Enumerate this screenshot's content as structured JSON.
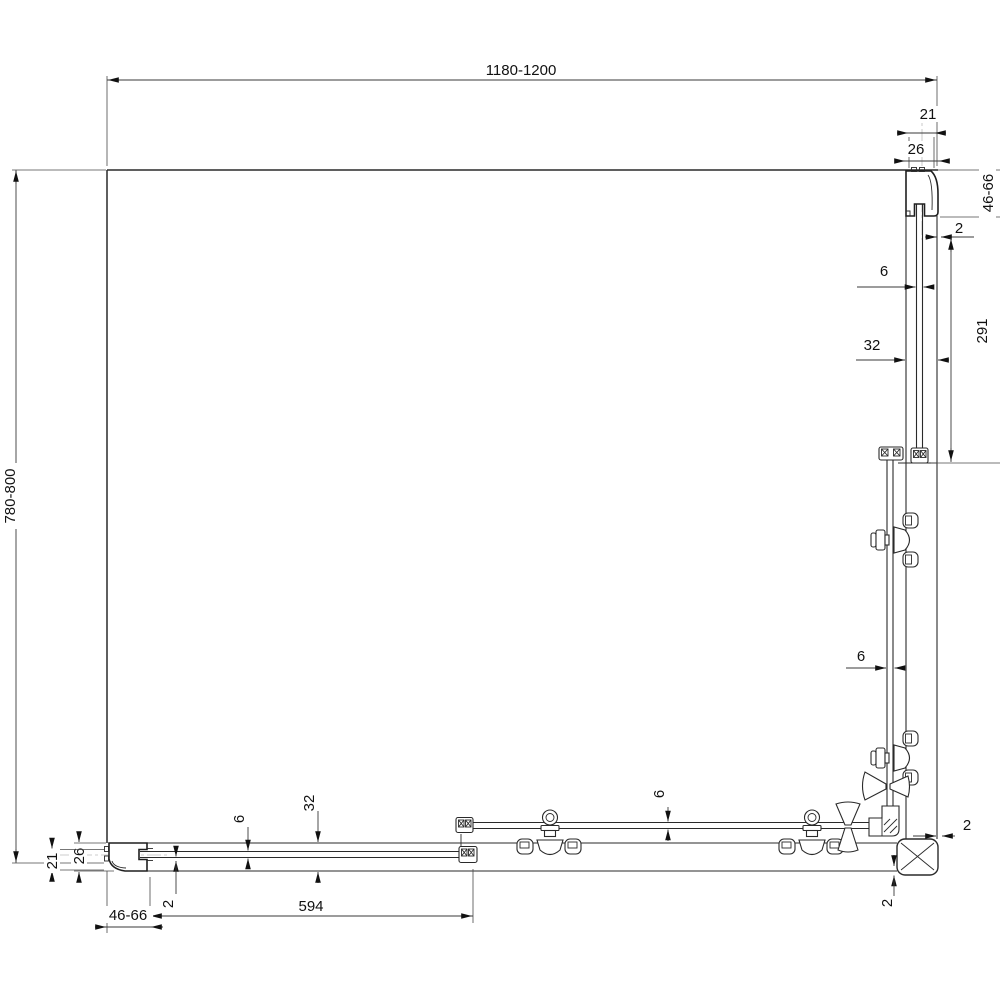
{
  "labels": {
    "overall_width": "1180-1200",
    "overall_depth": "780-800",
    "tr_inner": "21",
    "tr_outer": "26",
    "tr_height": "46-66",
    "tr_gap": "2",
    "r_glass": "6",
    "r_rail": "32",
    "r_fixed_len": "291",
    "r_glass2": "6",
    "r_gap2": "2",
    "br_gap": "2",
    "b_rail": "32",
    "b_glass": "6",
    "b_fixed_len": "594",
    "b_glass2": "6",
    "bl_gap": "2",
    "bl_inner": "21",
    "bl_outer": "26",
    "bl_height": "46-66"
  }
}
